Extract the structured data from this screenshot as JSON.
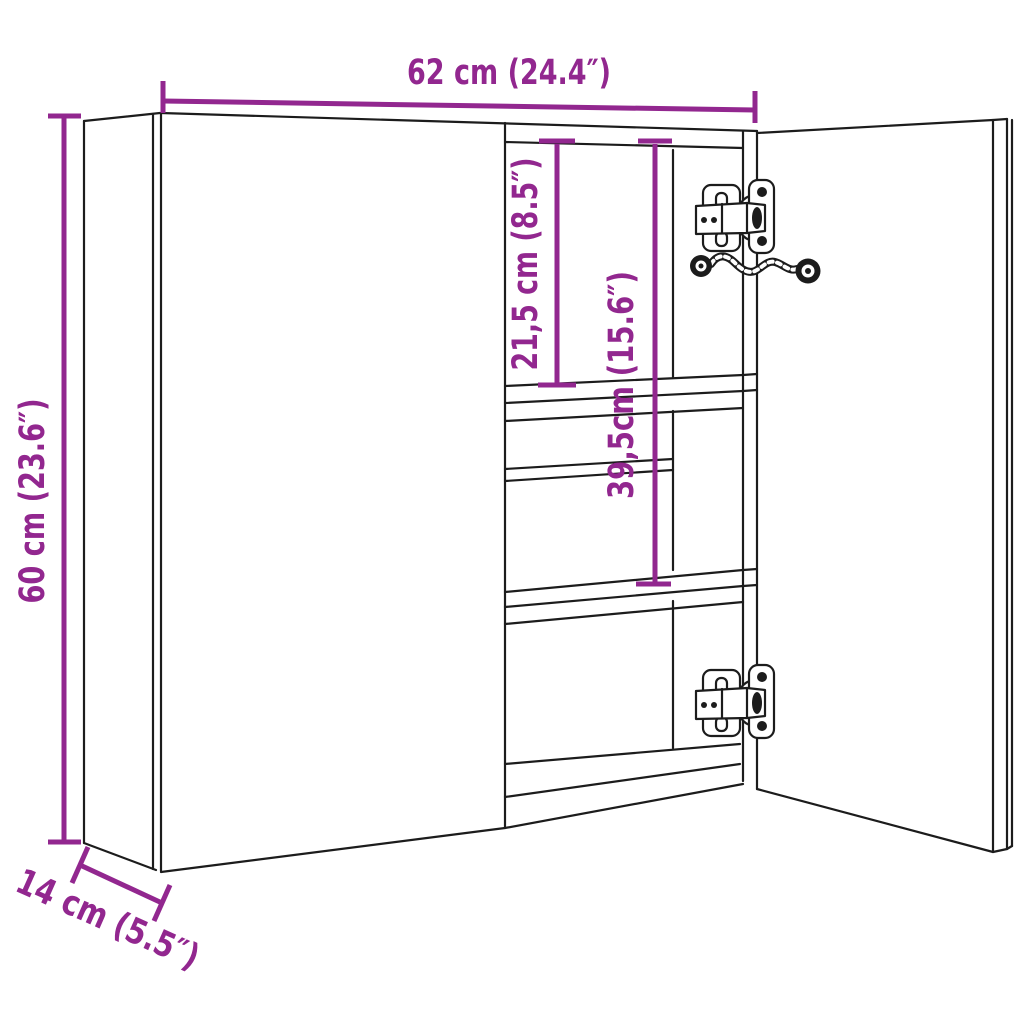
{
  "canvas": {
    "width": 1024,
    "height": 1024,
    "background_color": "#ffffff"
  },
  "colors": {
    "dimension_annotation": "#92278f",
    "drawing_line": "#1c1c1c"
  },
  "diagram": {
    "kind": "furniture-dimension-line-drawing",
    "subject": "two-door mirror cabinet with shelves, open right door, hinges and power cable"
  },
  "dimensions": {
    "width": {
      "label": "62 cm (24.4″)"
    },
    "height": {
      "label": "60 cm (23.6″)"
    },
    "depth": {
      "label": "14 cm (5.5″)"
    },
    "upper_compartment": {
      "label": "21,5 cm (8.5″)"
    },
    "shelf_section": {
      "label": "39,5cm (15.6″)"
    }
  },
  "icons": {
    "top_hinge": "concealed-hinge-icon",
    "bottom_hinge": "concealed-hinge-icon",
    "cable": "power-cable-icon"
  }
}
